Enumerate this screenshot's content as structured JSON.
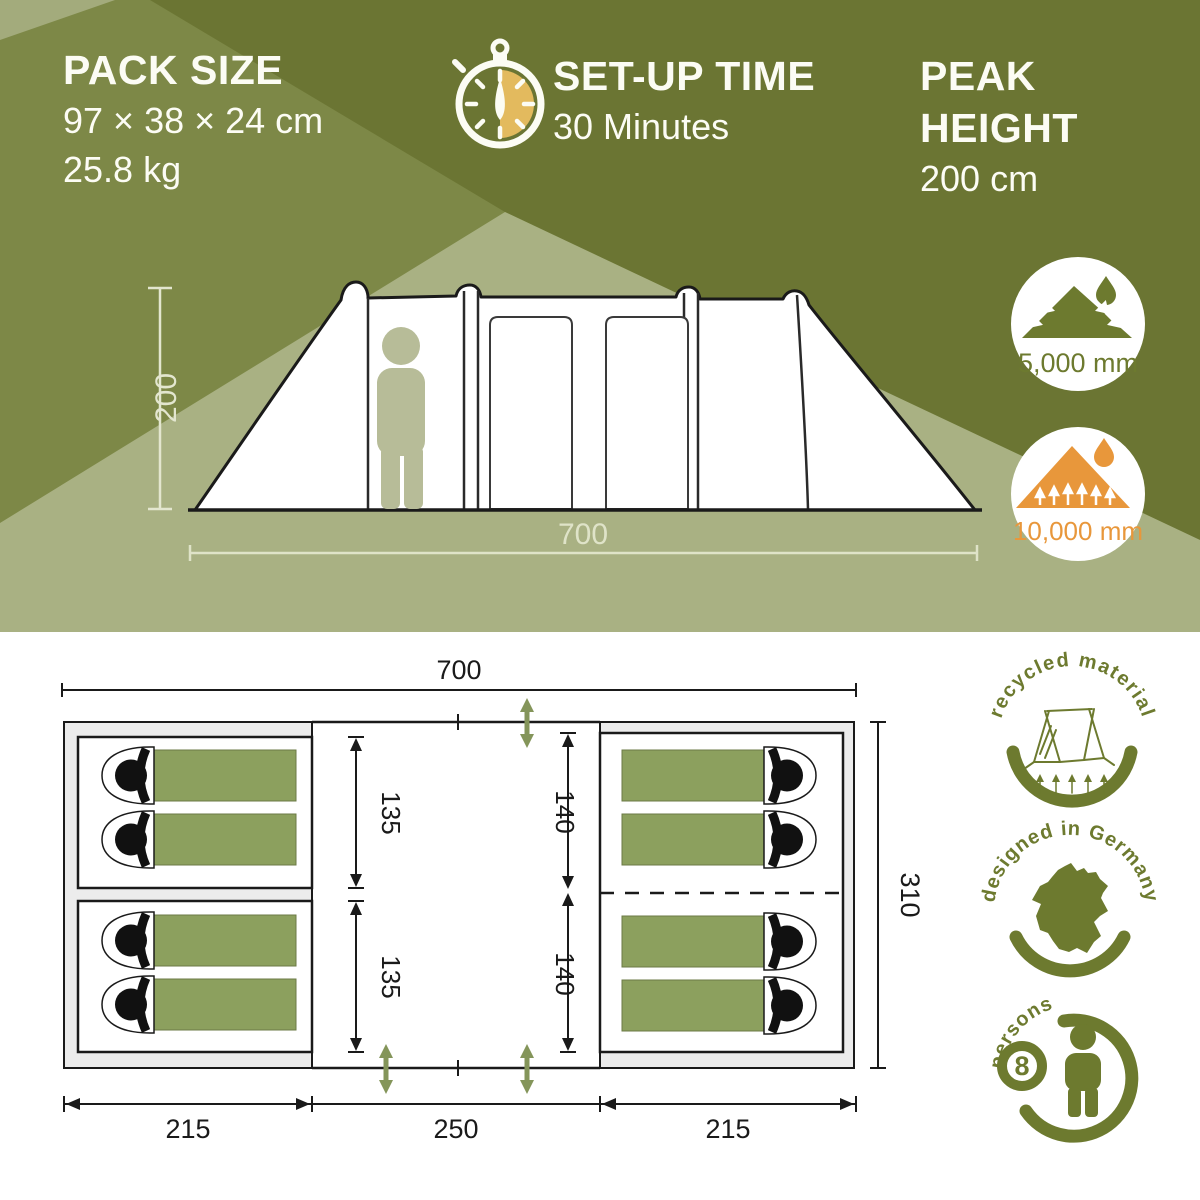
{
  "header": {
    "pack": {
      "title": "PACK SIZE",
      "dimensions": "97 × 38 × 24 cm",
      "weight": "25.8 kg"
    },
    "setup": {
      "title": "SET-UP TIME",
      "value": "30 Minutes"
    },
    "peak": {
      "title_line1": "PEAK",
      "title_line2": "HEIGHT",
      "value": "200 cm"
    }
  },
  "side_view": {
    "height_dim": "200",
    "width_dim": "700",
    "roof_water_column": "5,000 mm",
    "floor_water_column": "10,000 mm"
  },
  "floor_plan": {
    "width": "700",
    "depth": "310",
    "left_cabin_top": "135",
    "left_cabin_bottom": "135",
    "right_cabin_top": "140",
    "right_cabin_bottom": "140",
    "bottom_left": "215",
    "bottom_center": "250",
    "bottom_right": "215"
  },
  "badges": {
    "recycled": "recycled material",
    "germany": "designed in Germany",
    "persons_word": "persons",
    "persons_count": "8"
  },
  "colors": {
    "olive_dark": "#6b7533",
    "olive_medium": "#7d8847",
    "sage": "#a9b183",
    "sage_corner": "#a3ab7c",
    "badge_olive": "#6d7a2f",
    "orange": "#e8973b",
    "stopwatch_tan": "#e3ba5e",
    "bag_green": "#8ca05e",
    "figure_sage": "#b7bc98",
    "door_green": "#84955a",
    "ink": "#1a1a1a",
    "white": "#ffffff"
  }
}
